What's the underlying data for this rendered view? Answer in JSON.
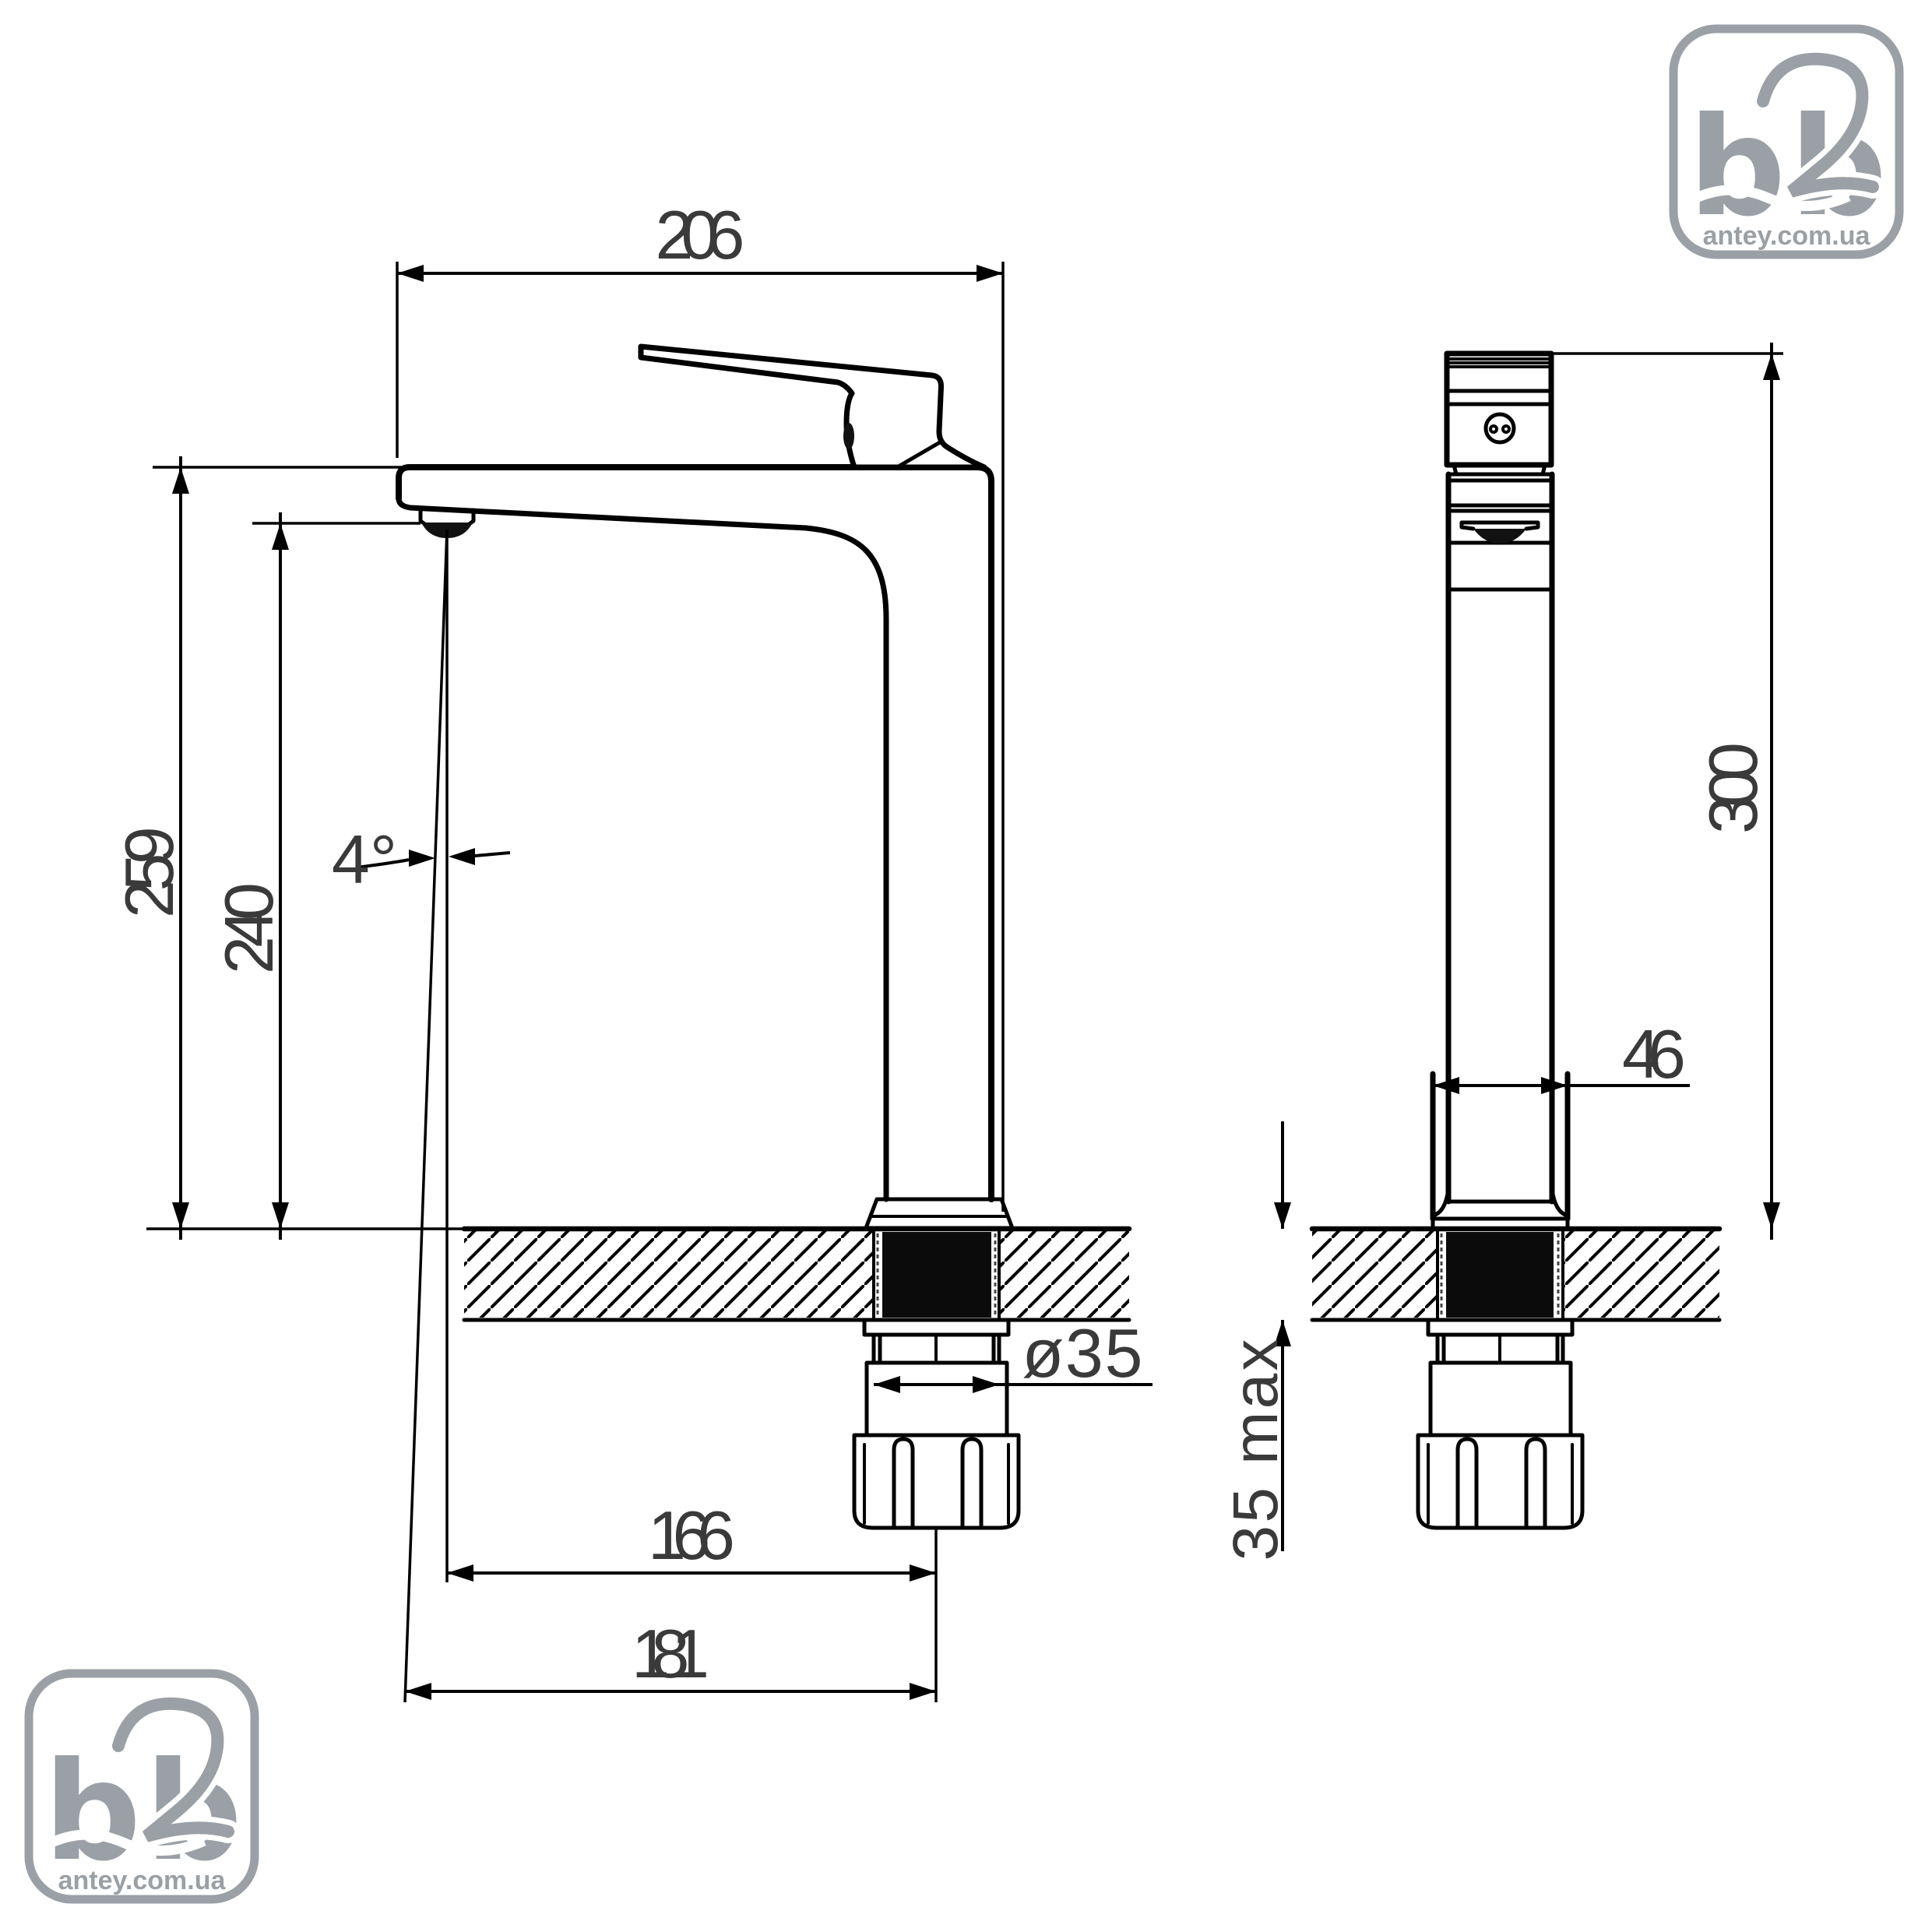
{
  "dimensions": {
    "spout_reach_total": "206",
    "height_to_body_top": "259",
    "height_to_aerator": "240",
    "spout_angle": "4°",
    "aerator_offset": "166",
    "front_offset": "181",
    "thread_diameter": "ø35",
    "base_width": "46",
    "overall_height": "300",
    "max_deck_thickness": "35 max"
  },
  "logo": {
    "letter_b": "b",
    "digit_2": "2",
    "domain": "antey.com.ua"
  },
  "colors": {
    "line": "#000000",
    "dim_text": "#3a3a3a",
    "logo_gray": "#9aa0a5",
    "background": "#ffffff"
  }
}
